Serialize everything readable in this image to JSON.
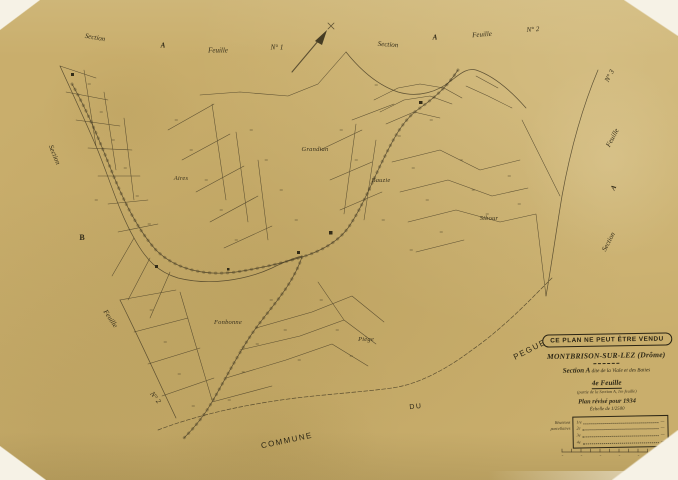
{
  "colors": {
    "paper": "#c9ae6c",
    "ink": "#453c24",
    "text": "#2e2816"
  },
  "margins": {
    "top_left": {
      "section": "Section",
      "a": "A",
      "feuille": "Feuille",
      "n": "N° 1"
    },
    "top_right": {
      "section": "Section",
      "a": "A",
      "feuille": "Feuille",
      "n": "N° 2"
    },
    "right": {
      "n": "N° 3",
      "feuille": "Feuille",
      "a": "A",
      "section": "Section"
    },
    "left": {
      "section": "Section",
      "b": "B"
    },
    "left_bottom": {
      "feuille": "Feuille",
      "n": "N° 2"
    },
    "bottom": {
      "commune": "COMMUNE",
      "du": "DU",
      "pegue": "PEGUE"
    }
  },
  "place_names": {
    "aires": "Aires",
    "grandian": "Grandian",
    "bauzie": "Bauzie",
    "sibour": "Sibour",
    "fonbonne": "Fonbonne",
    "piege": "Piège"
  },
  "stamp": {
    "text": "CE PLAN NE PEUT ÊTRE VENDU"
  },
  "title_block": {
    "commune_name": "MONTBRISON-SUR-LEZ (Drôme)",
    "section_label": "Section A",
    "section_desc": " dite de la Viale et des Baties",
    "sheet": "4e Feuille",
    "sheet_note": "(partie de la Section A, 1re feuille)",
    "revision": "Plan révisé pour 1934",
    "scale": "Échelle de 1/2500",
    "table_label_1": "Réunions",
    "table_label_2": "parcellaires",
    "table_rows": [
      {
        "label": "1re",
        "value": "—"
      },
      {
        "label": "2e",
        "value": "—"
      },
      {
        "label": "3e",
        "value": "—"
      },
      {
        "label": "4e",
        "value": "—"
      }
    ]
  }
}
